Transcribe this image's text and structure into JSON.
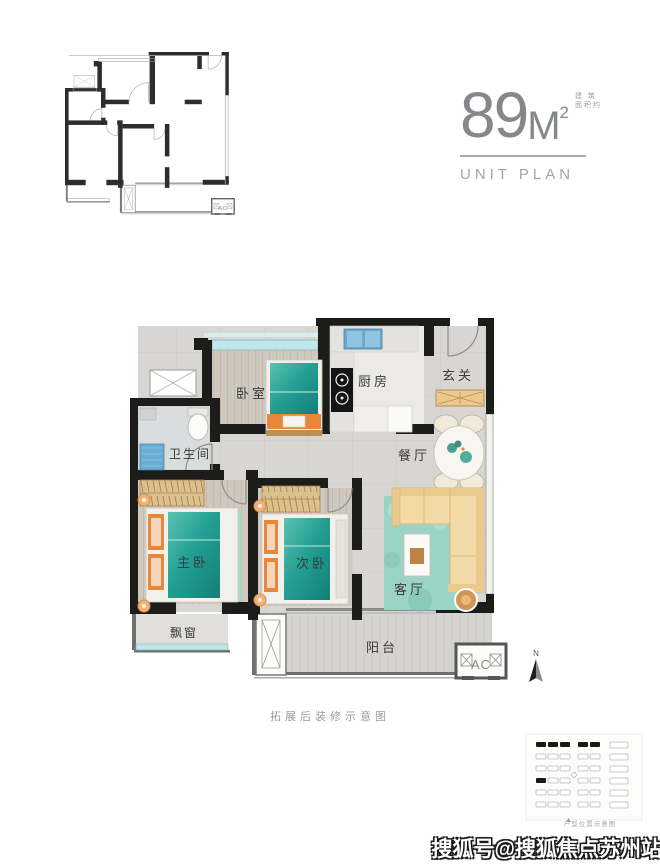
{
  "header": {
    "area_value": "89",
    "area_unit": "M",
    "area_exponent": "2",
    "area_note_top": "建 筑",
    "area_note_bottom": "面积约",
    "subtitle": "UNIT PLAN"
  },
  "rooms": {
    "bedroom": "卧室",
    "kitchen": "厨房",
    "foyer": "玄关",
    "bathroom": "卫生间",
    "dining": "餐厅",
    "master_bedroom": "主卧",
    "second_bedroom": "次卧",
    "living_room": "客厅",
    "bay_window": "飘窗",
    "balcony": "阳台"
  },
  "annotations": {
    "ac_unit": "AC",
    "north": "N",
    "caption": "拓展后装修示意图",
    "site_plan_caption": "户型位置示意图",
    "watermark": "搜狐号@搜狐焦点苏州站"
  },
  "colors": {
    "wall": "#1c1c1a",
    "window_teal": "#bfe7ea",
    "bed_teal": "#23a093",
    "pillow_orange": "#e8873a",
    "sofa_beige": "#f3d9a6",
    "wood": "#dcc08f",
    "header_gray": "#85888b"
  }
}
